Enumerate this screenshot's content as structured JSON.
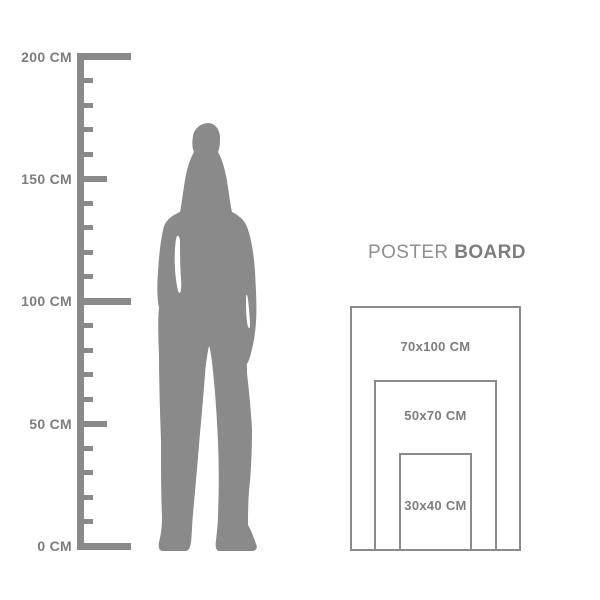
{
  "ruler": {
    "unit": "CM",
    "min_cm": 0,
    "max_cm": 200,
    "tick_interval_cm": 10,
    "labeled_values": [
      {
        "value": 200,
        "text": "200 CM"
      },
      {
        "value": 150,
        "text": "150 CM"
      },
      {
        "value": 100,
        "text": "100 CM"
      },
      {
        "value": 50,
        "text": "50 CM"
      },
      {
        "value": 0,
        "text": "0 CM"
      }
    ]
  },
  "figure": {
    "description": "standing-woman-silhouette"
  },
  "poster_board": {
    "title_regular": "POSTER",
    "title_bold": "BOARD",
    "sizes": [
      {
        "label": "70x100 CM",
        "width_cm": 70,
        "height_cm": 100
      },
      {
        "label": "50x70 CM",
        "width_cm": 50,
        "height_cm": 70
      },
      {
        "label": "30x40 CM",
        "width_cm": 30,
        "height_cm": 40
      }
    ]
  },
  "colors": {
    "shape_gray": "#8a8a8a",
    "text_gray": "#7d7d7d",
    "background": "#ffffff"
  }
}
